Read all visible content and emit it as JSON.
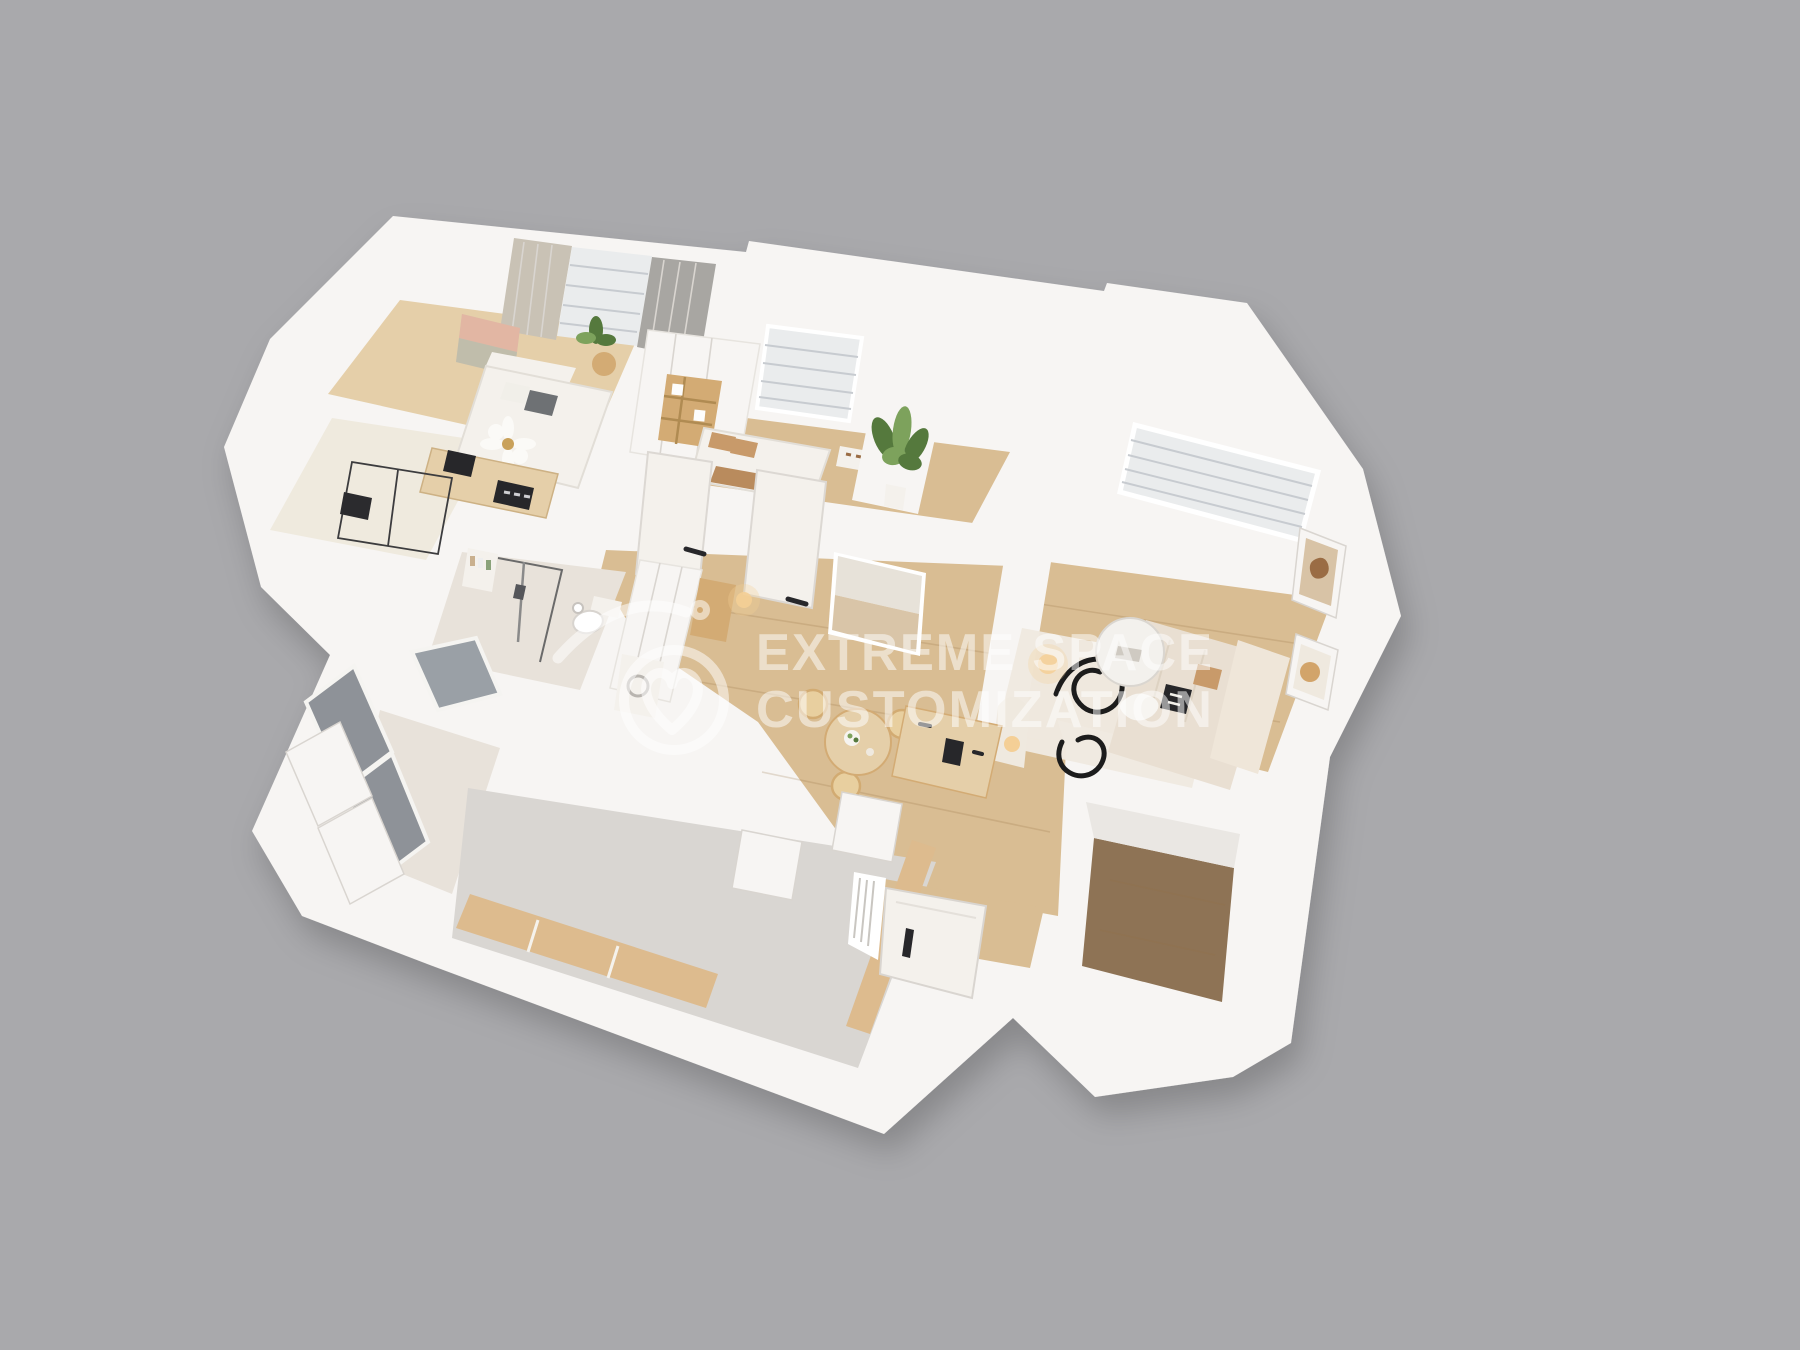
{
  "watermark": {
    "line1": "EXTREME SPACE",
    "line2": "CUSTOMIZATION",
    "logo": "heart-roof-circle-logo",
    "color": "#ffffff",
    "opacity": 0.52
  },
  "palette": {
    "bg": "#a9a9ac",
    "wall": "#f7f5f3",
    "wall_shade": "#eae7e3",
    "wall_edge": "#d9d5d0",
    "wood": "#d9bd93",
    "wood_light": "#e5cfa9",
    "wood_dark": "#8e7355",
    "floor_gray": "#d9d6d2",
    "tile": "#e8e2da",
    "glass": "#8e9298",
    "blind": "#eaeced",
    "blind_line": "#c7cbd0",
    "curtain": "#c9c2b5",
    "curtain_dark": "#a8a6a2",
    "tan": "#ddbb8e",
    "wood_furn": "#d3ab74",
    "white_soft": "#f4f1ec",
    "dark": "#27272a",
    "green": "#55793d",
    "green_light": "#7da25c",
    "warm": "#f4cf96",
    "cream": "#efe9df",
    "art_pink": "#e3b3a0",
    "art_sage": "#b5bca9",
    "print_tan": "#d8c3a6",
    "brown": "#9a6c44"
  }
}
